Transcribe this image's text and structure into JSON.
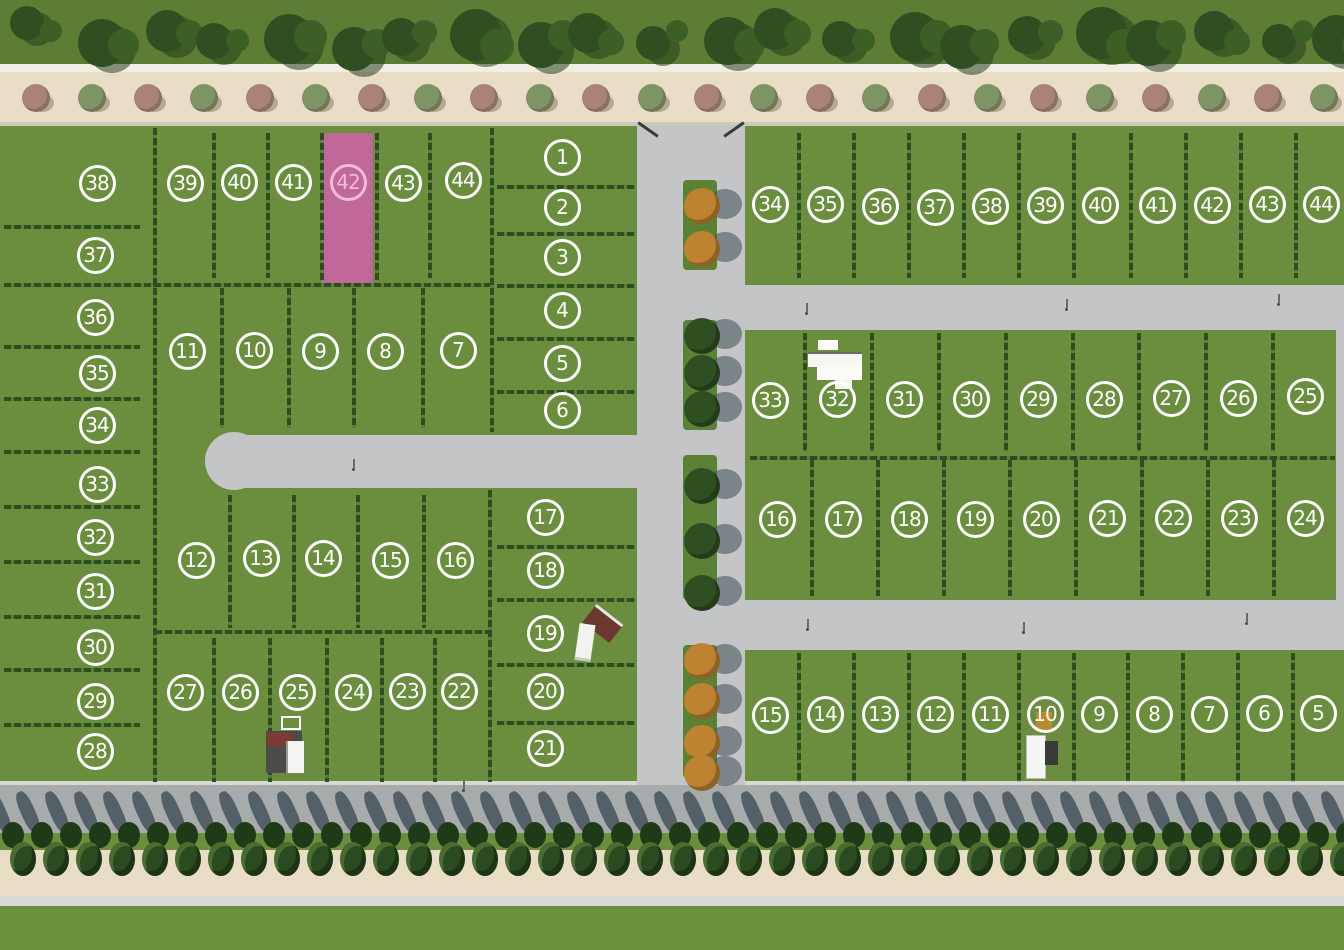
{
  "map": {
    "kind": "residential-lot-site-plan",
    "highlighted_lot_number": "42",
    "highlighted_block": "west"
  },
  "colors": {
    "grass": "#6b8e3e",
    "grass_top": "#5c7d33",
    "hedge": "#2e4d20",
    "road": "#c3c5c6",
    "road_dark": "#a8abac",
    "beige": "#e9dec5",
    "pink": "#bf6899",
    "pink_light": "#f2bcd8",
    "median": "#5a8134",
    "marker": "#ffffff",
    "tree_dark": "#2f4f22",
    "tree_orange": "#bd8331",
    "conifer": "#2a4a1f",
    "shadow": "#3f4e57"
  },
  "west_block": {
    "name": "west-block",
    "lots": [
      {
        "n": "38",
        "x": 97,
        "y": 183
      },
      {
        "n": "37",
        "x": 95,
        "y": 255
      },
      {
        "n": "36",
        "x": 95,
        "y": 317
      },
      {
        "n": "35",
        "x": 97,
        "y": 373
      },
      {
        "n": "34",
        "x": 97,
        "y": 425
      },
      {
        "n": "33",
        "x": 97,
        "y": 484
      },
      {
        "n": "32",
        "x": 95,
        "y": 537
      },
      {
        "n": "31",
        "x": 95,
        "y": 591
      },
      {
        "n": "30",
        "x": 95,
        "y": 647
      },
      {
        "n": "29",
        "x": 95,
        "y": 701
      },
      {
        "n": "28",
        "x": 95,
        "y": 751
      },
      {
        "n": "39",
        "x": 185,
        "y": 183
      },
      {
        "n": "40",
        "x": 239,
        "y": 182
      },
      {
        "n": "41",
        "x": 293,
        "y": 182
      },
      {
        "n": "42",
        "x": 348,
        "y": 182,
        "highlighted": true
      },
      {
        "n": "43",
        "x": 403,
        "y": 183
      },
      {
        "n": "44",
        "x": 463,
        "y": 180
      },
      {
        "n": "1",
        "x": 562,
        "y": 157
      },
      {
        "n": "2",
        "x": 562,
        "y": 207
      },
      {
        "n": "3",
        "x": 562,
        "y": 257
      },
      {
        "n": "4",
        "x": 562,
        "y": 310
      },
      {
        "n": "5",
        "x": 562,
        "y": 363
      },
      {
        "n": "6",
        "x": 562,
        "y": 410
      },
      {
        "n": "11",
        "x": 187,
        "y": 351
      },
      {
        "n": "10",
        "x": 254,
        "y": 350
      },
      {
        "n": "9",
        "x": 320,
        "y": 351
      },
      {
        "n": "8",
        "x": 385,
        "y": 351
      },
      {
        "n": "7",
        "x": 458,
        "y": 350
      },
      {
        "n": "12",
        "x": 196,
        "y": 560
      },
      {
        "n": "13",
        "x": 261,
        "y": 558
      },
      {
        "n": "14",
        "x": 323,
        "y": 558
      },
      {
        "n": "15",
        "x": 390,
        "y": 560
      },
      {
        "n": "16",
        "x": 455,
        "y": 560
      },
      {
        "n": "17",
        "x": 545,
        "y": 517
      },
      {
        "n": "18",
        "x": 545,
        "y": 570
      },
      {
        "n": "19",
        "x": 545,
        "y": 633
      },
      {
        "n": "20",
        "x": 545,
        "y": 691
      },
      {
        "n": "21",
        "x": 545,
        "y": 748
      },
      {
        "n": "27",
        "x": 185,
        "y": 692
      },
      {
        "n": "26",
        "x": 240,
        "y": 692
      },
      {
        "n": "25",
        "x": 297,
        "y": 692
      },
      {
        "n": "24",
        "x": 353,
        "y": 692
      },
      {
        "n": "23",
        "x": 407,
        "y": 691
      },
      {
        "n": "22",
        "x": 459,
        "y": 691
      }
    ]
  },
  "east_block": {
    "name": "east-block",
    "lots": [
      {
        "n": "34",
        "x": 770,
        "y": 204
      },
      {
        "n": "35",
        "x": 825,
        "y": 204
      },
      {
        "n": "36",
        "x": 880,
        "y": 206
      },
      {
        "n": "37",
        "x": 935,
        "y": 207
      },
      {
        "n": "38",
        "x": 990,
        "y": 206
      },
      {
        "n": "39",
        "x": 1045,
        "y": 205
      },
      {
        "n": "40",
        "x": 1100,
        "y": 205
      },
      {
        "n": "41",
        "x": 1157,
        "y": 205
      },
      {
        "n": "42",
        "x": 1212,
        "y": 205
      },
      {
        "n": "43",
        "x": 1267,
        "y": 204
      },
      {
        "n": "44",
        "x": 1321,
        "y": 204
      },
      {
        "n": "33",
        "x": 770,
        "y": 400
      },
      {
        "n": "32",
        "x": 837,
        "y": 399
      },
      {
        "n": "31",
        "x": 904,
        "y": 399
      },
      {
        "n": "30",
        "x": 971,
        "y": 399
      },
      {
        "n": "29",
        "x": 1038,
        "y": 399
      },
      {
        "n": "28",
        "x": 1104,
        "y": 399
      },
      {
        "n": "27",
        "x": 1171,
        "y": 398
      },
      {
        "n": "26",
        "x": 1238,
        "y": 398
      },
      {
        "n": "25",
        "x": 1305,
        "y": 396
      },
      {
        "n": "16",
        "x": 777,
        "y": 519
      },
      {
        "n": "17",
        "x": 843,
        "y": 519
      },
      {
        "n": "18",
        "x": 909,
        "y": 519
      },
      {
        "n": "19",
        "x": 975,
        "y": 519
      },
      {
        "n": "20",
        "x": 1041,
        "y": 519
      },
      {
        "n": "21",
        "x": 1107,
        "y": 518
      },
      {
        "n": "22",
        "x": 1173,
        "y": 518
      },
      {
        "n": "23",
        "x": 1239,
        "y": 518
      },
      {
        "n": "24",
        "x": 1305,
        "y": 518
      },
      {
        "n": "15",
        "x": 770,
        "y": 715
      },
      {
        "n": "14",
        "x": 825,
        "y": 714
      },
      {
        "n": "13",
        "x": 880,
        "y": 714
      },
      {
        "n": "12",
        "x": 935,
        "y": 714
      },
      {
        "n": "11",
        "x": 990,
        "y": 714
      },
      {
        "n": "10",
        "x": 1045,
        "y": 714
      },
      {
        "n": "9",
        "x": 1099,
        "y": 714
      },
      {
        "n": "8",
        "x": 1154,
        "y": 714
      },
      {
        "n": "7",
        "x": 1209,
        "y": 714
      },
      {
        "n": "6",
        "x": 1264,
        "y": 713
      },
      {
        "n": "5",
        "x": 1318,
        "y": 713
      }
    ]
  }
}
